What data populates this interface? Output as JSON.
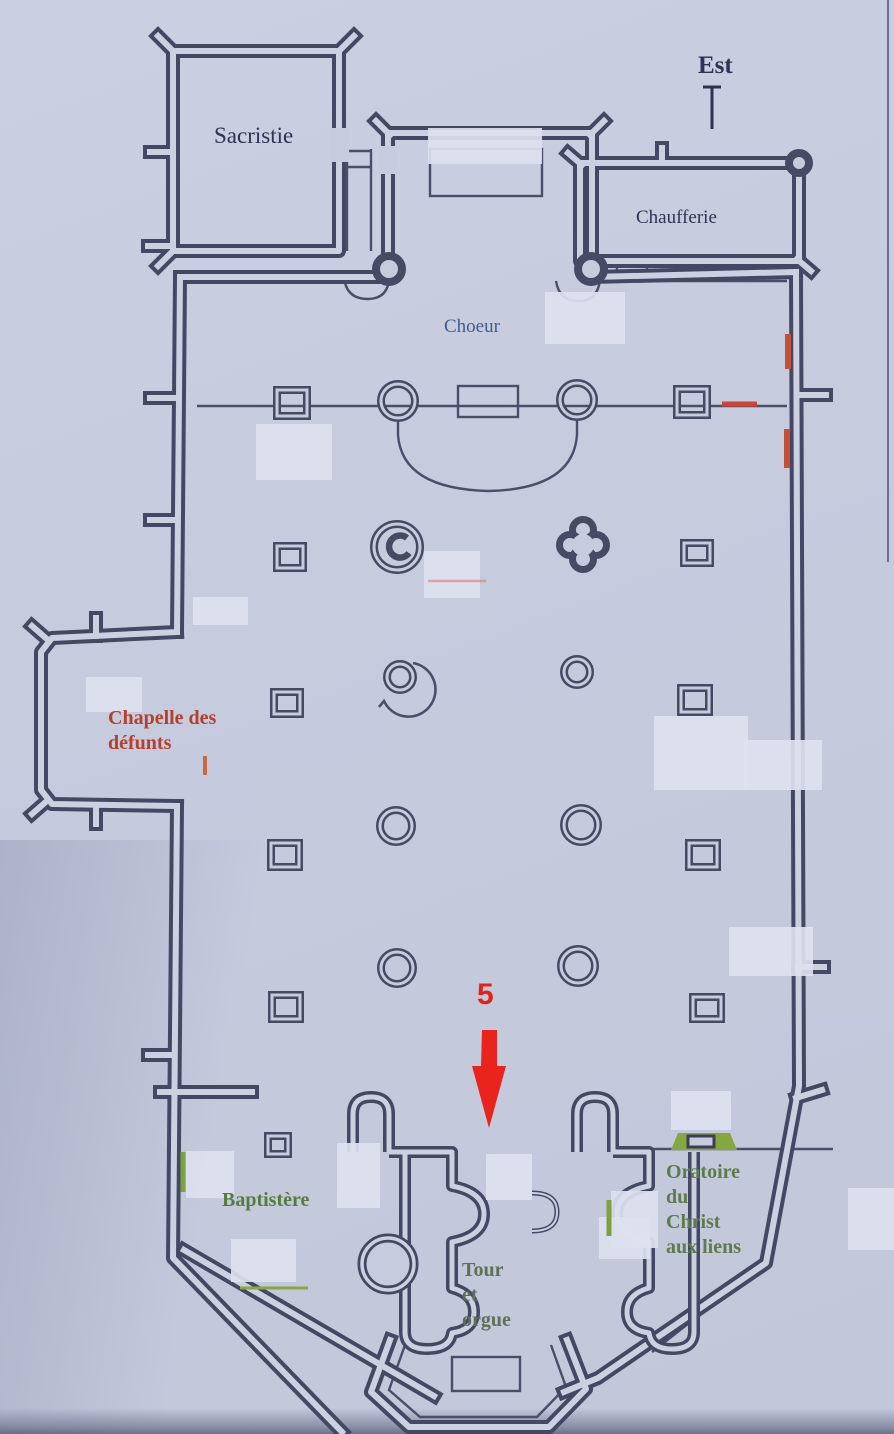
{
  "document": {
    "type": "church-floor-plan-scan",
    "orientation_marker": {
      "label": "Est"
    }
  },
  "labels": {
    "sacristie": {
      "text": "Sacristie"
    },
    "chaufferie": {
      "text": "Chaufferie"
    },
    "choeur": {
      "text": "Choeur"
    },
    "chapelle_defunts": {
      "line1": "Chapelle des",
      "line2": "défunts"
    },
    "baptistere": {
      "text": "Baptistère"
    },
    "tour_orgue": {
      "line1": "Tour",
      "line2": "et",
      "line3": "orgue"
    },
    "oratoire": {
      "line1": "Oratoire",
      "line2": "du",
      "line3": "Christ",
      "line4": "aux liens"
    }
  },
  "annotation": {
    "marker_number": "5"
  },
  "colors": {
    "paper": "#c6cbde",
    "wall": "#454863",
    "label_navy": "#2e3354",
    "label_blue": "#44598e",
    "label_red": "#b5402c",
    "label_green": "#557d3e",
    "marker_red": "#e32219",
    "mark_green": "#7ca23e",
    "mark_red_wall": "#c2503a"
  }
}
